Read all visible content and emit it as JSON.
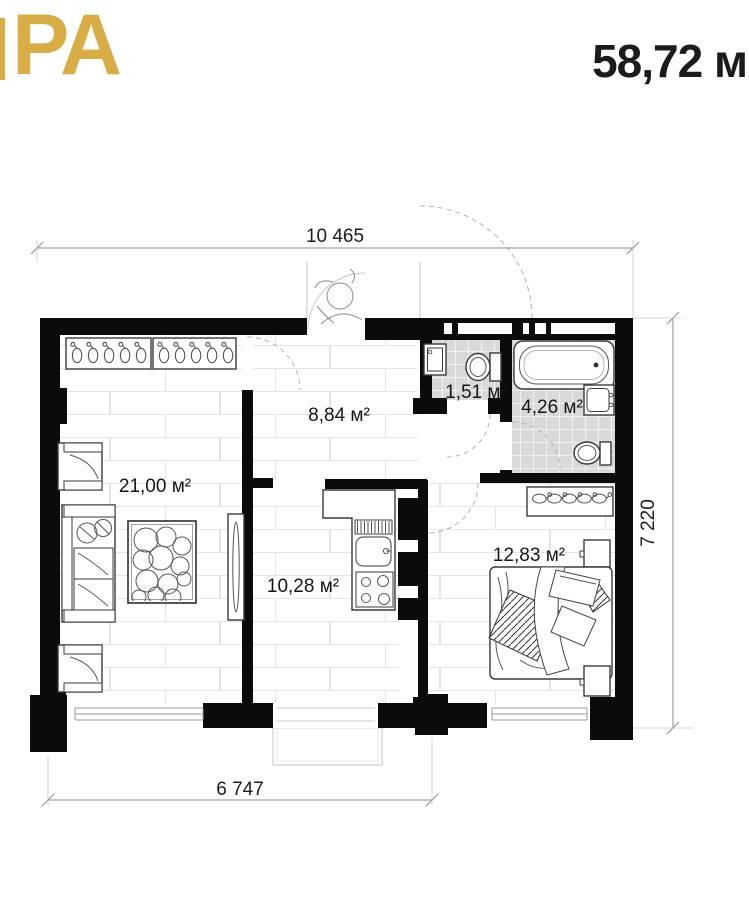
{
  "header": {
    "logo_text": "PA",
    "total_area": "58,72 м"
  },
  "dimensions": {
    "top": "10 465",
    "right": "7 220",
    "bottom": "6 747"
  },
  "rooms": [
    {
      "name": "living-room",
      "label": "21,00 м²"
    },
    {
      "name": "hallway",
      "label": "8,84 м²"
    },
    {
      "name": "wc",
      "label": "1,51 м²"
    },
    {
      "name": "bathroom",
      "label": "4,26 м²"
    },
    {
      "name": "kitchen",
      "label": "10,28 м²"
    },
    {
      "name": "bedroom",
      "label": "12,83 м²"
    }
  ],
  "colors": {
    "logo_gold": "#d9ad45",
    "wall_black": "#0b0b0b",
    "tile_gray": "#d9d9d9",
    "title_black": "#1b1b1b"
  }
}
